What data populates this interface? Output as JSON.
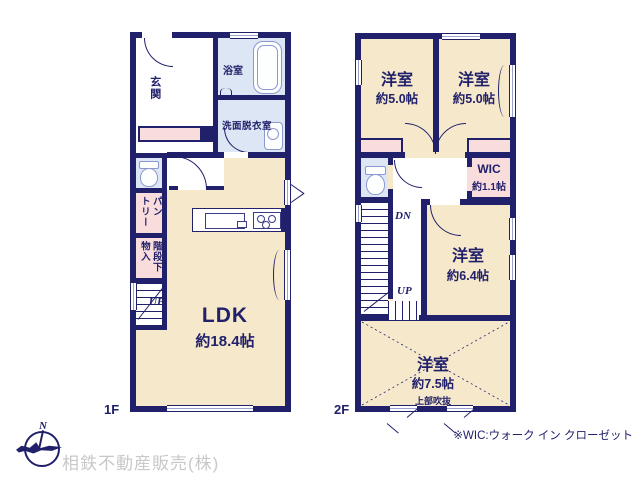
{
  "f1": {
    "floor_label": "1F",
    "genkan": "玄関",
    "bath": "浴室",
    "washroom": "洗面脱衣室",
    "pantry": "パン\nトリー",
    "storage": "階段下\n物入",
    "up": "UP",
    "ldk": "LDK",
    "ldk_size": "約18.4帖"
  },
  "f2": {
    "floor_label": "2F",
    "room_a": "洋室",
    "room_a_size": "約5.0帖",
    "room_b": "洋室",
    "room_b_size": "約5.0帖",
    "wic": "WIC",
    "wic_size": "約1.1帖",
    "dn": "DN",
    "up": "UP",
    "room_c": "洋室",
    "room_c_size": "約6.4帖",
    "room_d": "洋室",
    "room_d_size": "約7.5帖",
    "void_note": "上部吹抜"
  },
  "footer": {
    "north": "N",
    "company": "相鉄不動産販売(株)",
    "wic_note": "※WIC:ウォーク イン クローゼット"
  },
  "colors": {
    "wall": "#21216b",
    "floor": "#f6e8cb",
    "wet_area": "#dce6f4",
    "accent_pink": "#f9dddd",
    "window": "#99a3d1",
    "company_text": "#c8c8c8"
  }
}
